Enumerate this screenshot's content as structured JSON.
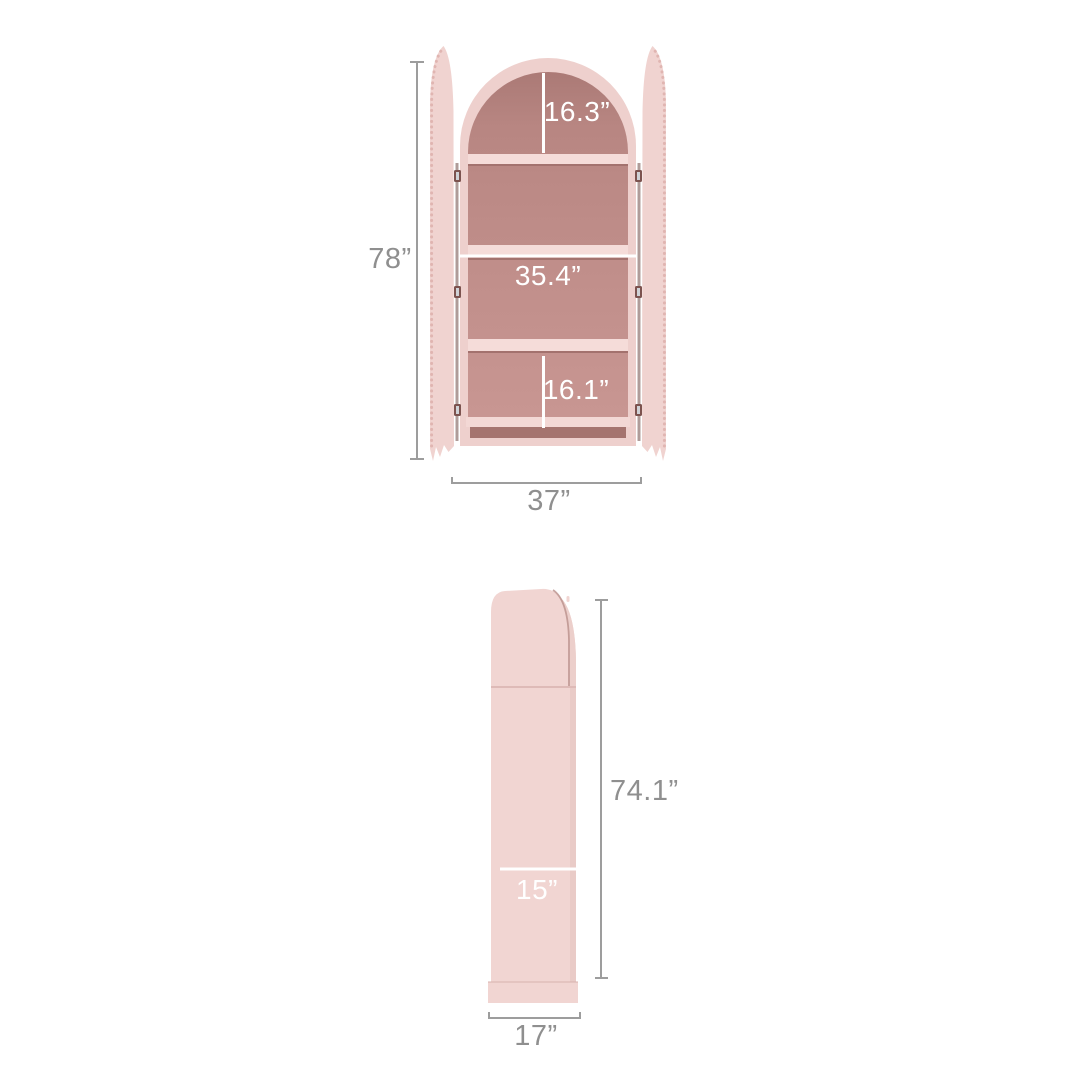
{
  "page": {
    "type": "product-dimension-diagram",
    "background": "#ffffff",
    "product_name": "Arched cabinet bookcase with scalloped doors"
  },
  "colors": {
    "cabinet_pink": "#eed0cd",
    "door_pink": "#f0d3d0",
    "side_panel_pink": "#f1d5d2",
    "interior_mauve": "#bd8c88",
    "shelf_pink": "#f5dcd9",
    "shelf_shadow": "#a3726e",
    "toe_kick_shadow": "#a5746f",
    "scallop_edge": "#e0b5b1",
    "dimension_line_gray": "#9d9d9d",
    "dimension_text_gray": "#8f8f8f",
    "interior_dimension_white": "#ffffff"
  },
  "front_view": {
    "view_name": "front view, doors open",
    "labels": {
      "overall_height": "78”",
      "overall_width": "37”",
      "arch_opening_height": "16.3”",
      "interior_width": "35.4”",
      "lower_opening_height": "16.1”"
    }
  },
  "side_view": {
    "view_name": "side view",
    "labels": {
      "side_height": "74.1”",
      "interior_depth": "15”",
      "overall_depth": "17”"
    }
  }
}
